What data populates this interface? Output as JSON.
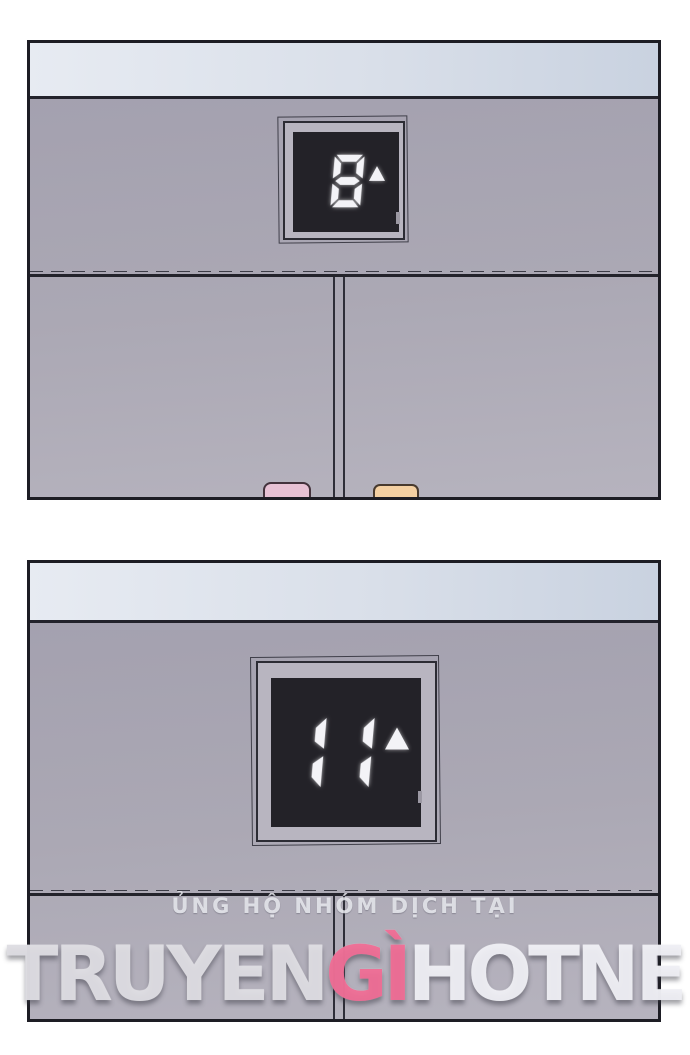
{
  "page": {
    "background_color": "#ffffff"
  },
  "panels": [
    {
      "name": "elevator-hall-floor-8",
      "display": {
        "floor": "8",
        "direction": "up"
      },
      "people": [
        {
          "name": "person-head-pink",
          "hair_color": "#e7c1d4"
        },
        {
          "name": "person-head-orange",
          "hair_color": "#f4d0a2"
        }
      ]
    },
    {
      "name": "elevator-hall-floor-11",
      "display": {
        "floor": "11",
        "direction": "up"
      }
    }
  ],
  "icons": {
    "up_arrow": "up-triangle"
  },
  "colors": {
    "panel_border": "#1d1d24",
    "ceiling": "#d9dfe9",
    "wall_top": "#a29fae",
    "wall_bottom": "#b6b3be",
    "display_frame": "#b8b5c0",
    "display_screen": "#232228",
    "segment": "#f3f3f7",
    "head_pink": "#e7c1d4",
    "head_orange": "#f4d0a2",
    "brand_light": "#dddce2",
    "brand_pink": "#ee6c94"
  },
  "watermark": {
    "support_text": "ỦNG HỘ NHÓM DỊCH TẠI",
    "brand": {
      "part1": "TRUYEN",
      "part2": "GÌ",
      "part3": "HOTNE"
    }
  }
}
